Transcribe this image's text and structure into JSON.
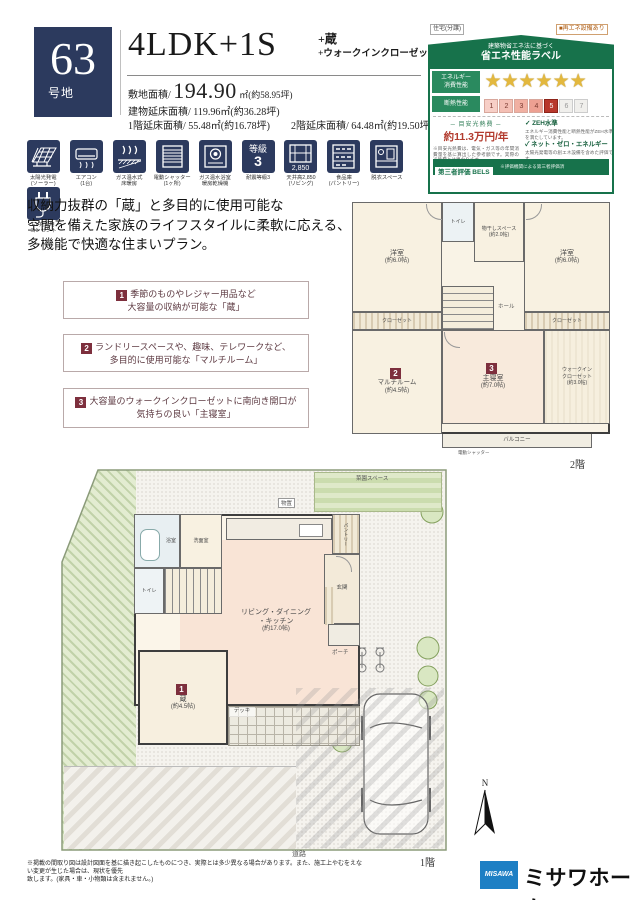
{
  "colors": {
    "navy": "#2c3a5e",
    "label_green": "#17724b",
    "badge_maroon": "#7d2f3d",
    "star_gold": "#e3b83e",
    "cost_red": "#b23b2e",
    "logo_blue": "#1d7fc4"
  },
  "header": {
    "lot_number": "63",
    "lot_suffix": "号地",
    "title": "4LDK+1S",
    "title_sub1": "+蔵",
    "title_sub2": "+ウォークインクローゼット+パントリー",
    "area1_label": "敷地面積/",
    "area1_value": "194.90",
    "area1_unit": "㎡(約58.95坪)",
    "area2_label": "建物延床面積/",
    "area2_value": "119.96㎡(約36.28坪)",
    "area3_label": "1階延床面積/",
    "area3_value": "55.48㎡(約16.78坪)",
    "area4_label": "2階延床面積/",
    "area4_value": "64.48㎡(約19.50坪)"
  },
  "energy_label": {
    "tag_left": "住宅(分譲)",
    "tag_right": "■再エネ設備あり",
    "header_small": "建築物省エネ法に基づく",
    "header": "省エネ性能ラベル",
    "row1_label1": "エネルギー",
    "row1_label2": "消費性能",
    "stars": "★★★★★★",
    "row2_label": "断熱性能",
    "scale": [
      "1",
      "2",
      "3",
      "4",
      "5",
      "6",
      "7"
    ],
    "cost_label": "─ 目安光熱費 ─",
    "cost_value": "約11.3万円/年",
    "cost_note1": "※目安光熱費は、電気・ガス等の年間消費量を基に算出した参考額です。実際の光熱費とは異なります。",
    "check1": "✓ ZEH水準",
    "check1_note": "エネルギー消費性能と断熱性能がZEH水準を満たしています。",
    "check2": "✓ ネット・ゼロ・エネルギー",
    "check2_note": "太陽光発電等の創エネ設備を含めた評価です。",
    "footer_box": "第三者評価 BELS",
    "footer_note": "※評価機関による第三者評価済"
  },
  "feature_icons": [
    {
      "icon": "solar-panel",
      "label1": "太陽光発電",
      "label2": "(ソーラー)"
    },
    {
      "icon": "air-conditioner",
      "label1": "エアコン",
      "label2": "(1台)"
    },
    {
      "icon": "floor-heating",
      "label1": "ガス温水式",
      "label2": "床暖房"
    },
    {
      "icon": "electric-shutter",
      "label1": "電動シャッター",
      "label2": "(1ヶ所)"
    },
    {
      "icon": "bath-dryer",
      "label1": "ガス温水浴室",
      "label2": "暖房乾燥機"
    },
    {
      "icon": "seismic-grade",
      "label1": "耐震等級3",
      "label2": "",
      "glyph1": "等級",
      "glyph2": "3"
    },
    {
      "icon": "high-ceiling",
      "label1": "天井高2,850",
      "label2": "(リビング)",
      "glyph1": "2,850"
    },
    {
      "icon": "pantry",
      "label1": "食品庫",
      "label2": "(パントリー)"
    },
    {
      "icon": "dressing-space",
      "label1": "脱衣スペース",
      "label2": ""
    },
    {
      "icon": "ev-outlet",
      "label1": "EV充電用",
      "label2": "コンセント"
    }
  ],
  "description": [
    "収納力抜群の「蔵」と多目的に使用可能な",
    "空間を備えた家族のライフスタイルに柔軟に応える、",
    "多機能で快適な住まいプラン。"
  ],
  "points": [
    {
      "num": "1",
      "line1": "季節のものやレジャー用品など",
      "line2": "大容量の収納が可能な「蔵」"
    },
    {
      "num": "2",
      "line1": "ランドリースペースや、趣味、テレワークなど、",
      "line2": "多目的に使用可能な「マルチルーム」"
    },
    {
      "num": "3",
      "line1": "大容量のウォークインクローゼットに南向き開口が",
      "line2": "気持ちの良い「主寝室」"
    }
  ],
  "floor2": {
    "label": "2階",
    "bed1_name": "洋室",
    "bed1_size": "(約6.0帖)",
    "bed2_name": "洋室",
    "bed2_size": "(約6.0帖)",
    "closet": "クローゼット",
    "toilet": "トイレ",
    "drying_name": "物干しスペース",
    "drying_size": "(約2.0帖)",
    "hall": "ホール",
    "multi_badge": "2",
    "multi_name": "マルチルーム",
    "multi_size": "(約4.5帖)",
    "master_badge": "3",
    "master_name": "主寝室",
    "master_size": "(約7.0帖)",
    "wic_name": "ウォークイン",
    "wic_name2": "クローゼット",
    "wic_size": "(約3.0帖)",
    "balcony": "バルコニー",
    "balcony_note": "電動シャッター"
  },
  "floor1": {
    "label": "1階",
    "bath": "浴室",
    "wash": "洗面室",
    "toilet": "トイレ",
    "pantry": "パントリー",
    "ldk_line1": "リビング・ダイニング",
    "ldk_line2": "・キッチン",
    "ldk_size": "(約17.0帖)",
    "kura_badge": "1",
    "kura_name": "蔵",
    "kura_size": "(約4.5帖)",
    "genkan": "玄関",
    "porch": "ポーチ",
    "deck": "デッキ",
    "garden": "菜園スペース",
    "shed": "物置",
    "road": "道路",
    "north": "N"
  },
  "footer": {
    "disclaimer1": "※掲載の間取り図は設計図面を基に描き起こしたものにつき、実際とは多少異なる場合があります。また、施工上やむをえない変更が生じた場合は、現状を優先",
    "disclaimer2": "致します。(家具・車・小物類は含まれません。)",
    "logo_box": "MISAWA",
    "logo_text": "ミサワホーム"
  }
}
